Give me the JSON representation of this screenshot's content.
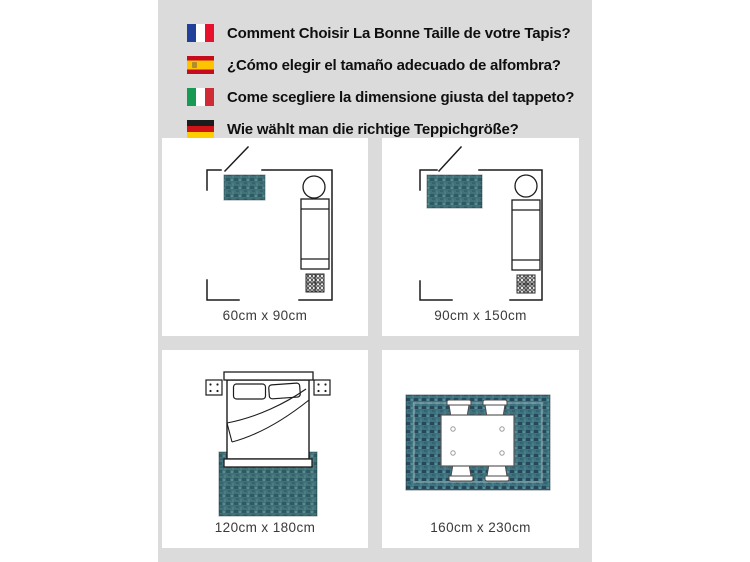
{
  "header": {
    "lines": [
      {
        "flag": "france",
        "text": "Comment Choisir La Bonne Taille de votre Tapis?"
      },
      {
        "flag": "spain",
        "text": "¿Cómo elegir el tamaño adecuado de alfombra?"
      },
      {
        "flag": "italy",
        "text": "Come scegliere la dimensione giusta del tappeto?"
      },
      {
        "flag": "germany",
        "text": "Wie wählt man die richtige Teppichgröße?"
      }
    ]
  },
  "panels": [
    {
      "scene": "room-floor-plan-small-rug",
      "label": "60cm x 90cm"
    },
    {
      "scene": "room-floor-plan-medium-rug",
      "label": "90cm x 150cm"
    },
    {
      "scene": "bed-top-view-on-rug",
      "label": "120cm x 180cm"
    },
    {
      "scene": "dining-table-on-rug",
      "label": "160cm x 230cm"
    }
  ],
  "colors": {
    "canvas_background": "#dbdbdb",
    "panel_background": "#ffffff",
    "rug_teal": "#41727a",
    "rug_teal_dining": "#3d737e",
    "heading_text": "#0f0f0f",
    "label_text": "#3a3a3a",
    "flag_france": [
      "#21409a",
      "#ffffff",
      "#e8112d"
    ],
    "flag_spain": [
      "#c60b1e",
      "#ffc400"
    ],
    "flag_italy": [
      "#169a54",
      "#ffffff",
      "#ce2b37"
    ],
    "flag_germany": [
      "#1c1c1c",
      "#d01317",
      "#ffce00"
    ]
  }
}
